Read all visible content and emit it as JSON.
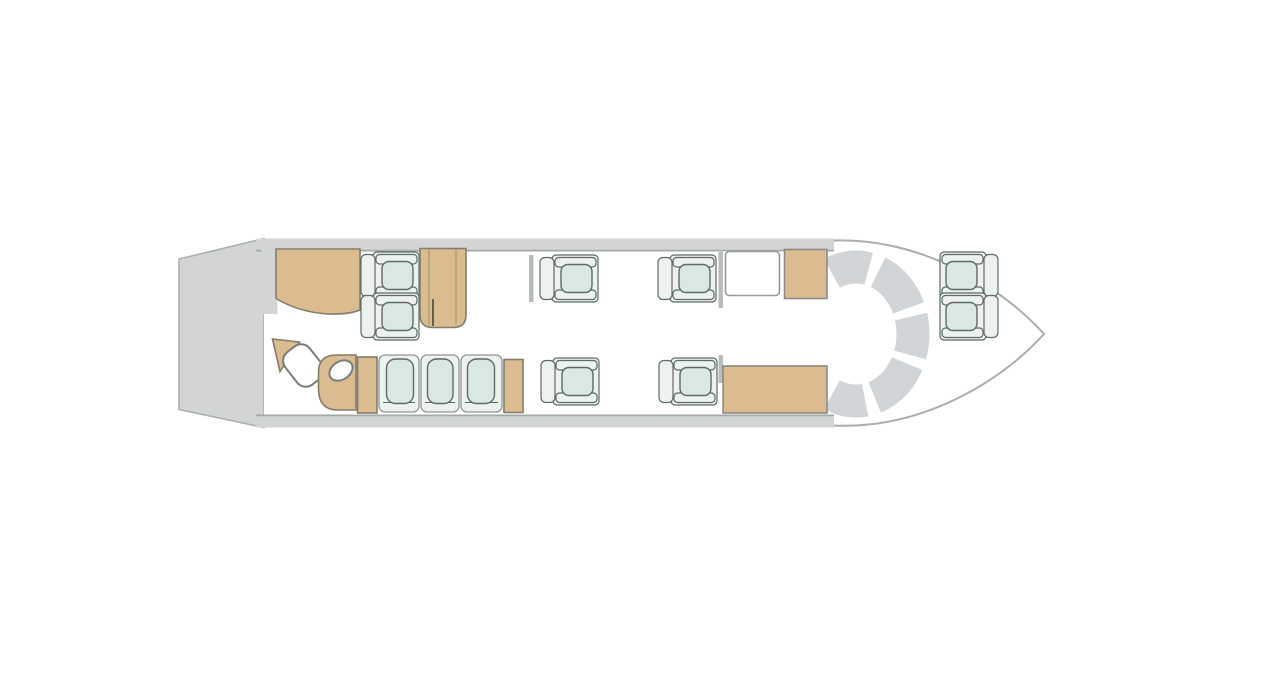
{
  "diagram": {
    "type": "aircraft-cabin-floorplan",
    "orientation": "nose-right",
    "seating_summary": {
      "club_four_seats": 4,
      "single_forward_seats": 4,
      "divan_seats": 3,
      "total_passenger_seats": 11
    },
    "components": [
      {
        "name": "tail-cone",
        "kind": "structure"
      },
      {
        "name": "cabin-walls",
        "kind": "structure"
      },
      {
        "name": "nose-outline",
        "kind": "structure"
      },
      {
        "name": "cockpit-arc",
        "kind": "cockpit-instrument-panel",
        "segments": 5
      },
      {
        "name": "wardrobe-cabinet",
        "kind": "furniture-tan"
      },
      {
        "name": "lavatory",
        "kind": "zone",
        "fixtures": [
          "corner-shelf",
          "toilet",
          "vanity-sink"
        ]
      },
      {
        "name": "club-four-group",
        "kind": "seating",
        "table": "conference-table"
      },
      {
        "name": "three-place-divan",
        "kind": "seating",
        "end_cabinets": 2
      },
      {
        "name": "single-seats",
        "kind": "seating",
        "count": 4
      },
      {
        "name": "galley-counter",
        "kind": "furniture-white"
      },
      {
        "name": "galley-cabinet-forward-top",
        "kind": "furniture-tan"
      },
      {
        "name": "galley-cabinet-forward-bottom",
        "kind": "furniture-tan"
      },
      {
        "name": "cabin-partitions",
        "kind": "structure",
        "count": 3
      }
    ]
  },
  "colors": {
    "background": "#ffffff",
    "fuselage_gray": "#d2d4d5",
    "fuselage_edge": "#a9adae",
    "cockpit_arc": "#d2d5d7",
    "furniture_tan": "#dabc90",
    "furniture_outline": "#847c6a",
    "seat_shell": "#edf2f0",
    "seat_cushion": "#d9e8e2",
    "seat_outline": "#5c6a68",
    "fixture_white": "#ffffff",
    "fixture_outline": "#787d7d",
    "partition_gray": "#b9bcbe"
  }
}
